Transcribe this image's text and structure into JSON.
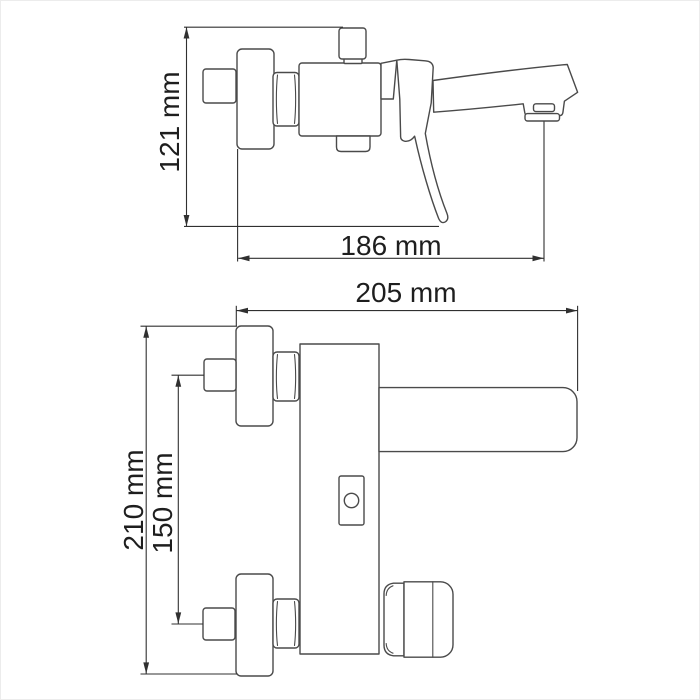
{
  "image": {
    "description": "Technical dimension drawing of a wall-mounted single-lever bath mixer tap: side view (top) and front view (bottom)",
    "background_color": "#ffffff",
    "line_color": "#4a4a4a",
    "dimension_line_color": "#303030",
    "text_color": "#1e1e1e"
  },
  "side_view": {
    "dim_height": "121 mm",
    "dim_depth": "186 mm"
  },
  "front_view": {
    "dim_width": "205 mm",
    "dim_overall_height": "210 mm",
    "dim_inlet_spacing": "150 mm"
  }
}
